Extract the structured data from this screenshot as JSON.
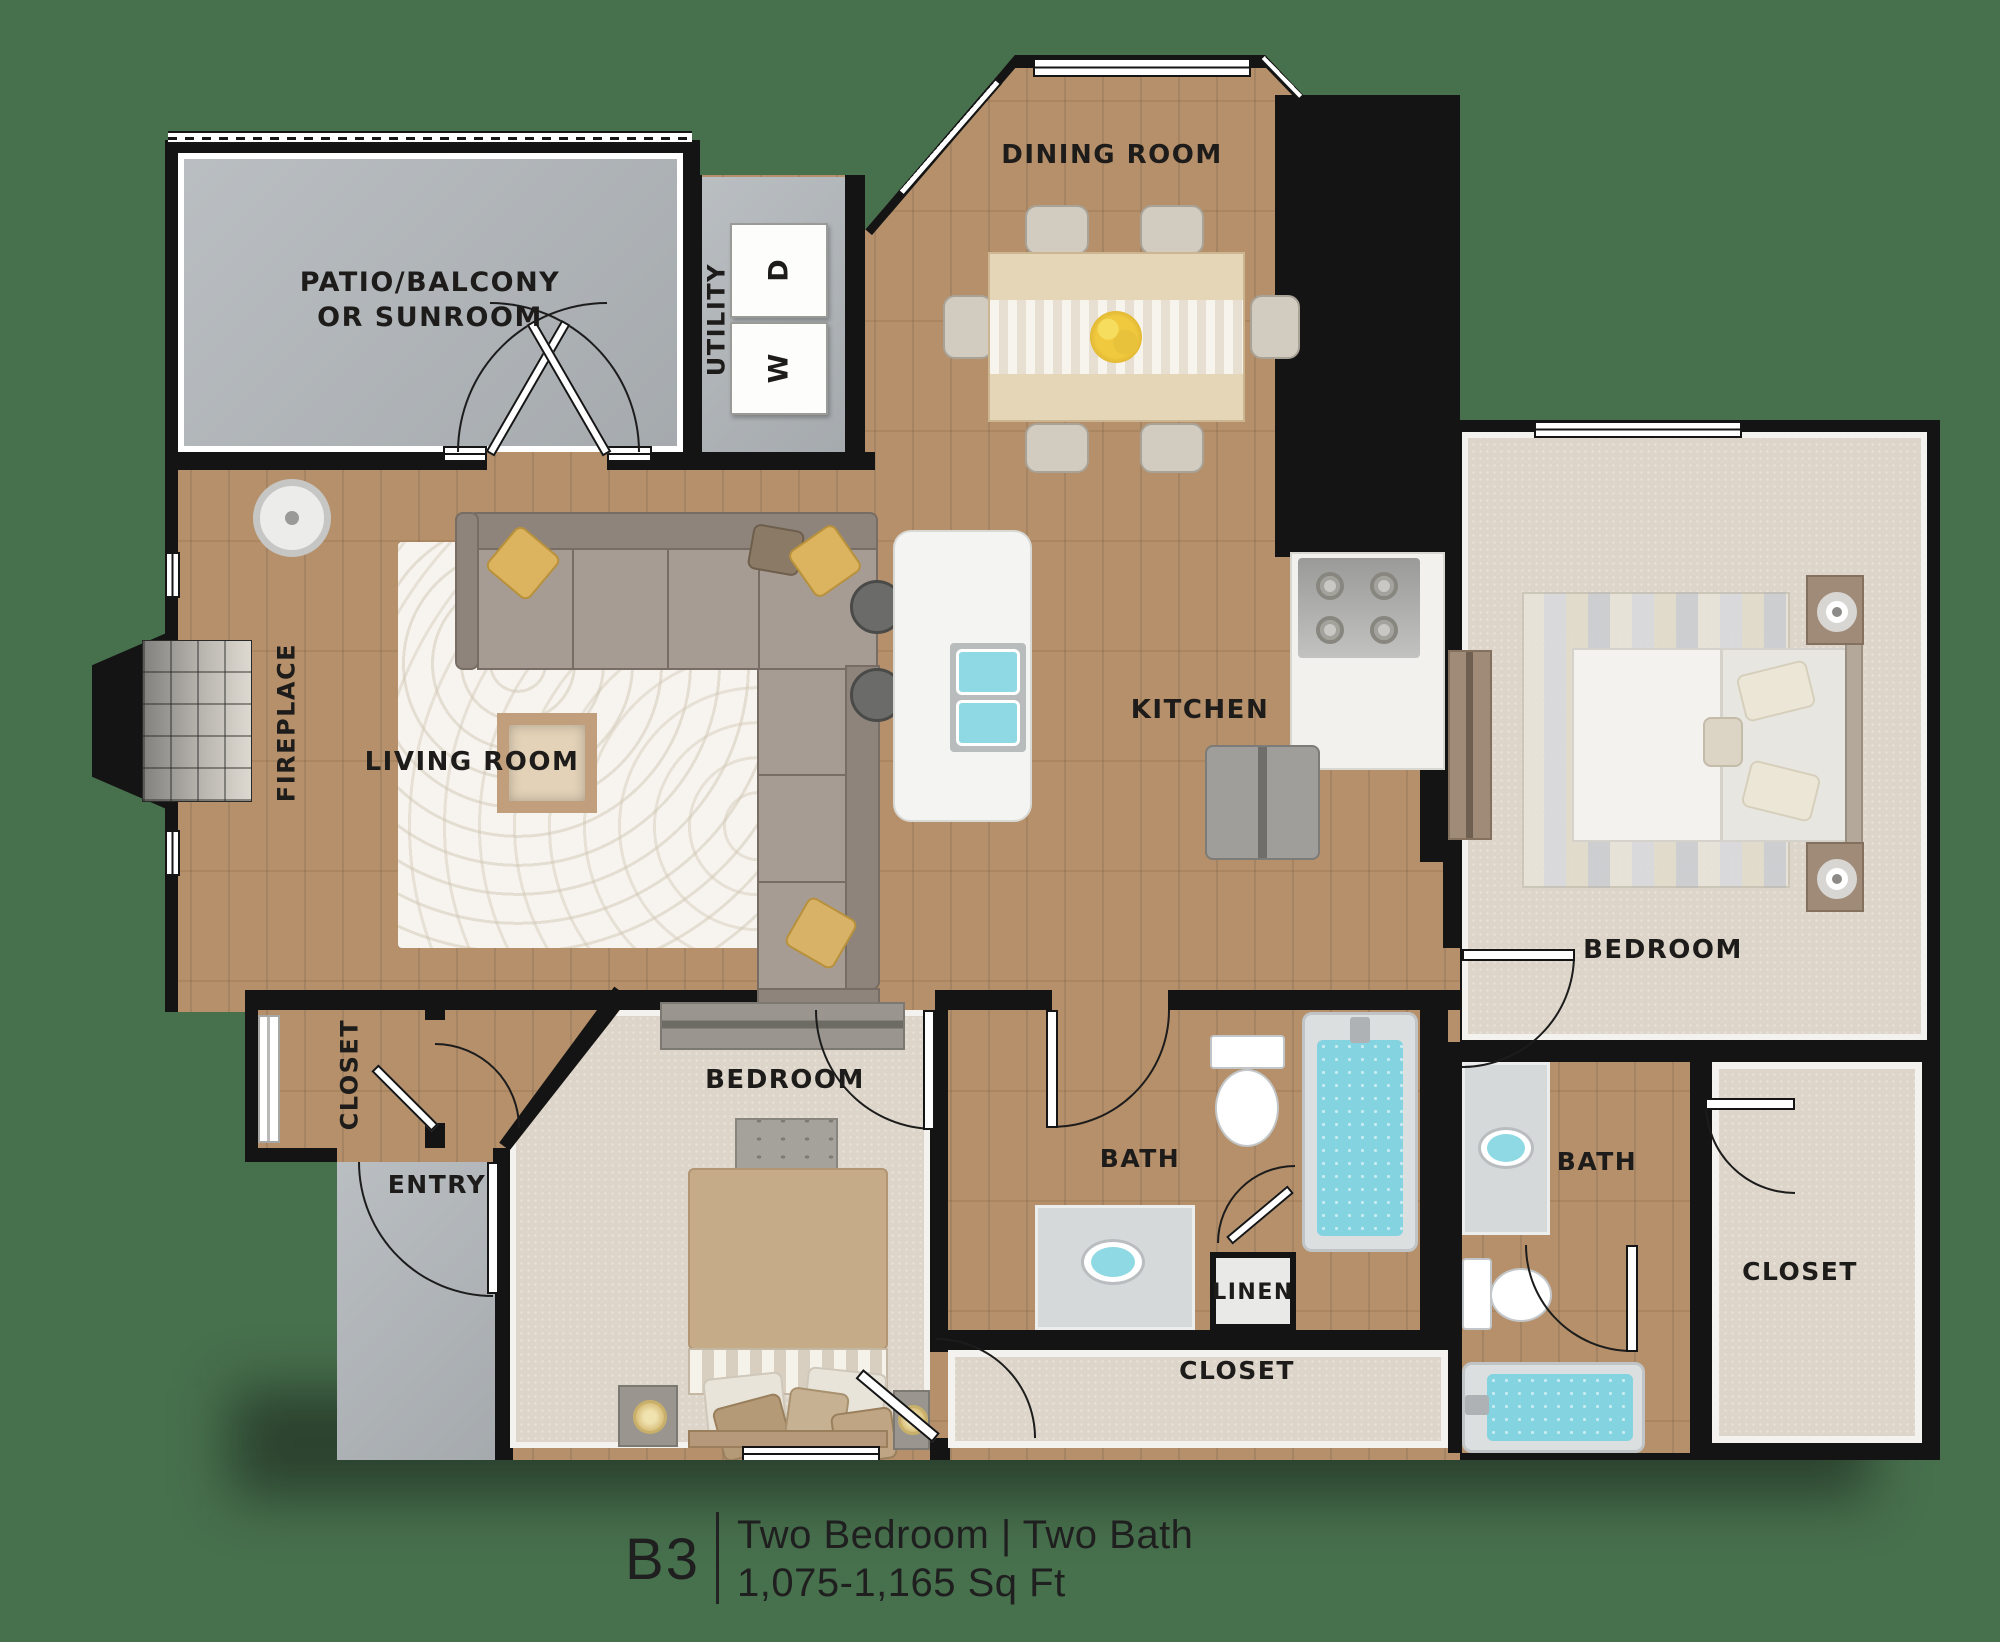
{
  "canvas": {
    "background": "#47704d"
  },
  "title": {
    "code": "B3",
    "line1": "Two Bedroom | Two Bath",
    "line2": "1,075-1,165 Sq Ft"
  },
  "labels": {
    "dining": "DINING ROOM",
    "patio": "PATIO/BALCONY OR SUNROOM",
    "utility": "UTILITY",
    "fireplace": "FIREPLACE",
    "living": "LIVING ROOM",
    "kitchen": "KITCHEN",
    "bedroom_right": "BEDROOM",
    "bedroom_bottom": "BEDROOM",
    "bath_main": "BATH",
    "bath_second": "BATH",
    "linen": "LINEN",
    "closet_main": "CLOSET",
    "closet_second": "CLOSET",
    "closet_entry": "CLOSET",
    "entry": "ENTRY",
    "washer": "W",
    "dryer": "D"
  },
  "colors": {
    "background": "#47704d",
    "wall": "#141414",
    "wood_floor": "#b5906a",
    "carpet": "#ddd5c9",
    "hard_surface": "#b2b7bb",
    "water": "#84d3e0",
    "accent_pillow": "#dcb35e"
  }
}
